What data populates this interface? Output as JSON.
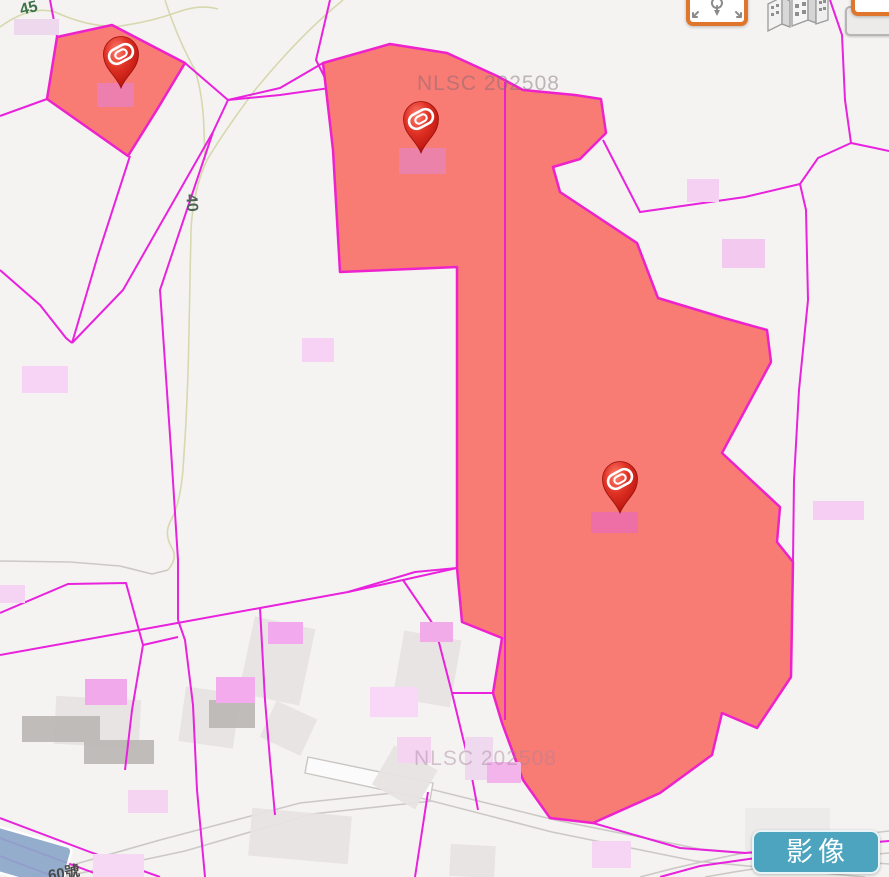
{
  "map": {
    "watermark": "NLSC 202508",
    "contour_label_45": "45",
    "contour_label_40": "40",
    "house_number": "60號",
    "pin_count": 3,
    "layer_type": "cadastral parcels over base map"
  },
  "toolbar": {
    "imagery_label": "影像",
    "icons": [
      "locate-pin-icon",
      "buildings-3d-icon",
      "layers-icon"
    ]
  },
  "colors": {
    "parcel_line": "#e822dd",
    "selection_fill": "#f87b74",
    "selection_stroke": "#ee22cc",
    "imagery_button": "#4ca4bf",
    "control_border": "#e0752c",
    "contour_line": "#d6d8ae",
    "pin_red": "#d61c12",
    "background": "#f5f3f2"
  }
}
